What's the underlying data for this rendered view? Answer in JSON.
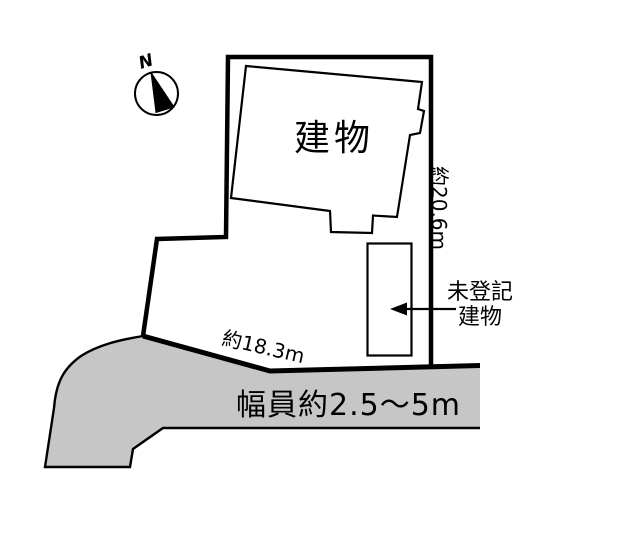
{
  "diagram": {
    "compass_label": "N",
    "building_label": "建物",
    "right_dimension": "約20.6m",
    "bottom_dimension": "約18.3m",
    "unregistered_building_label_line1": "未登記",
    "unregistered_building_label_line2": "建物",
    "road_width_label": "幅員約2.5〜5m"
  },
  "colors": {
    "road_fill": "#c6c6c6",
    "line": "#000000",
    "background": "#ffffff"
  },
  "icons": {
    "compass": "north-arrow-icon"
  }
}
